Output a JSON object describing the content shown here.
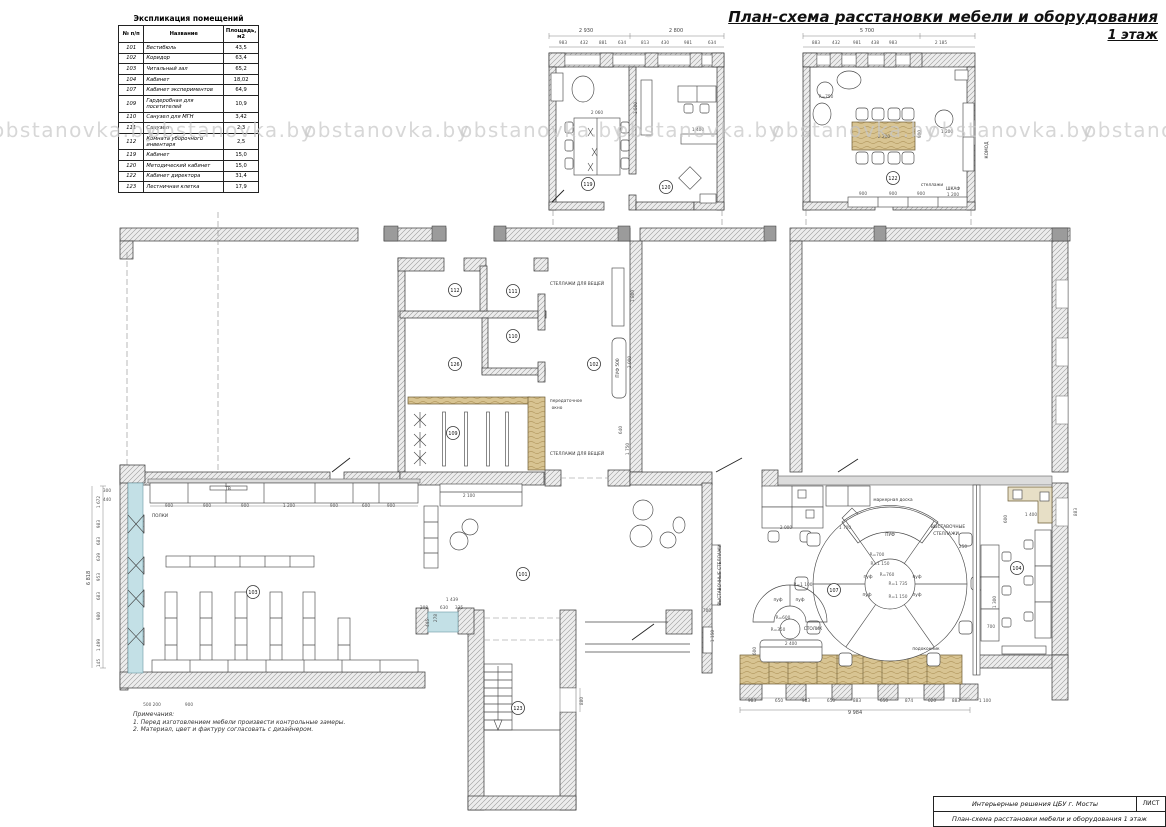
{
  "page": {
    "title_line1": "План-схема расстановки мебели и оборудования",
    "title_line2": "1 этаж"
  },
  "watermark": {
    "text": "obstanovka.by",
    "y": 118,
    "xs": [
      -8,
      148,
      304,
      460,
      616,
      772,
      928,
      1084
    ]
  },
  "legend": {
    "title": "Экспликация помещений",
    "headers": [
      "№ п/п",
      "Название",
      "Площадь, м2"
    ],
    "rows": [
      [
        "101",
        "Вестибюль",
        "43,5"
      ],
      [
        "102",
        "Коридор",
        "63,4"
      ],
      [
        "103",
        "Читальный зал",
        "65,2"
      ],
      [
        "104",
        "Кабинет",
        "18,02"
      ],
      [
        "107",
        "Кабинет экспериментов",
        "64,9"
      ],
      [
        "109",
        "Гардеробная для посетителей",
        "10,9"
      ],
      [
        "110",
        "Санузел для МГН",
        "3,42"
      ],
      [
        "111",
        "Санузел",
        "2,3"
      ],
      [
        "112",
        "Комната уборочного инвентаря",
        "2,5"
      ],
      [
        "119",
        "Кабинет",
        "15,0"
      ],
      [
        "120",
        "Методический кабинет",
        "15,0"
      ],
      [
        "122",
        "Кабинет директора",
        "31,4"
      ],
      [
        "123",
        "Лестничная клетка",
        "17,9"
      ]
    ]
  },
  "notes": {
    "heading": "Примечания:",
    "items": [
      "1. Перед изготовлением мебели произвести контрольные замеры.",
      "2. Материал, цвет и фактуру согласовать с дизайнером."
    ]
  },
  "title_block": {
    "project": "Интерьерные решения ЦБУ г. Мосты",
    "sheet_label": "ЛИСТ",
    "drawing_title": "План-схема расстановки мебели и оборудования 1 этаж"
  },
  "colors": {
    "wall_hatch": "#9b9b9b",
    "wall_band": "#dcdcdc",
    "accent_wood": "#d8c492",
    "accent_blue": "#c3e0e6",
    "watermark": "#c7c7c7"
  },
  "plan": {
    "rooms": [
      {
        "number": "119",
        "x": 588,
        "y": 184
      },
      {
        "number": "120",
        "x": 666,
        "y": 187
      },
      {
        "number": "122",
        "x": 893,
        "y": 178
      },
      {
        "number": "112",
        "x": 455,
        "y": 290
      },
      {
        "number": "111",
        "x": 513,
        "y": 291
      },
      {
        "number": "110",
        "x": 513,
        "y": 336
      },
      {
        "number": "126",
        "x": 455,
        "y": 364
      },
      {
        "number": "102",
        "x": 594,
        "y": 364
      },
      {
        "number": "109",
        "x": 453,
        "y": 433
      },
      {
        "number": "101",
        "x": 523,
        "y": 574
      },
      {
        "number": "103",
        "x": 253,
        "y": 592
      },
      {
        "number": "107",
        "x": 834,
        "y": 590
      },
      {
        "number": "104",
        "x": 1017,
        "y": 568
      },
      {
        "number": "123",
        "x": 518,
        "y": 708
      }
    ],
    "texts": [
      {
        "t": "2 930",
        "x": 586,
        "y": 32,
        "c": "tD"
      },
      {
        "t": "2 800",
        "x": 676,
        "y": 32,
        "c": "tD"
      },
      {
        "t": "983",
        "x": 563,
        "y": 44
      },
      {
        "t": "432",
        "x": 584,
        "y": 44
      },
      {
        "t": "881",
        "x": 603,
        "y": 44
      },
      {
        "t": "634",
        "x": 622,
        "y": 44
      },
      {
        "t": "813",
        "x": 645,
        "y": 44
      },
      {
        "t": "430",
        "x": 665,
        "y": 44
      },
      {
        "t": "981",
        "x": 688,
        "y": 44
      },
      {
        "t": "634",
        "x": 712,
        "y": 44
      },
      {
        "t": "2 060",
        "x": 597,
        "y": 114
      },
      {
        "t": "1 500",
        "x": 637,
        "y": 108,
        "r": -90
      },
      {
        "t": "1 400",
        "x": 698,
        "y": 131
      },
      {
        "t": "5 700",
        "x": 867,
        "y": 32,
        "c": "tD"
      },
      {
        "t": "883",
        "x": 816,
        "y": 44
      },
      {
        "t": "432",
        "x": 836,
        "y": 44
      },
      {
        "t": "981",
        "x": 857,
        "y": 44
      },
      {
        "t": "438",
        "x": 875,
        "y": 44
      },
      {
        "t": "983",
        "x": 893,
        "y": 44
      },
      {
        "t": "2 185",
        "x": 941,
        "y": 44
      },
      {
        "t": "R=750",
        "x": 826,
        "y": 98
      },
      {
        "t": "2 200",
        "x": 884,
        "y": 138
      },
      {
        "t": "900",
        "x": 921,
        "y": 134,
        "r": -90
      },
      {
        "t": "1 200",
        "x": 947,
        "y": 133
      },
      {
        "t": "стеллажи",
        "x": 932,
        "y": 186,
        "c": "tl"
      },
      {
        "t": "900",
        "x": 863,
        "y": 195
      },
      {
        "t": "900",
        "x": 893,
        "y": 195
      },
      {
        "t": "900",
        "x": 921,
        "y": 195
      },
      {
        "t": "ШКАФ",
        "x": 953,
        "y": 190,
        "c": "tl"
      },
      {
        "t": "1 200",
        "x": 953,
        "y": 196
      },
      {
        "t": "КОМОД",
        "x": 988,
        "y": 150,
        "r": -90,
        "c": "tl"
      },
      {
        "t": "СТЕЛЛАЖИ ДЛЯ ВЕЩЕЙ",
        "x": 577,
        "y": 285,
        "c": "tl"
      },
      {
        "t": "СТЕЛЛАЖИ ДЛЯ ВЕЩЕЙ",
        "x": 577,
        "y": 455,
        "c": "tl"
      },
      {
        "t": "1 800",
        "x": 634,
        "y": 296,
        "r": -90
      },
      {
        "t": "2 000",
        "x": 631,
        "y": 362,
        "r": -90
      },
      {
        "t": "ПУФ 500",
        "x": 619,
        "y": 368,
        "r": -90,
        "c": "tl"
      },
      {
        "t": "передаточное",
        "x": 566,
        "y": 402,
        "c": "tl"
      },
      {
        "t": "окно",
        "x": 557,
        "y": 409,
        "c": "tl"
      },
      {
        "t": "640",
        "x": 622,
        "y": 430,
        "r": -90
      },
      {
        "t": "1 750",
        "x": 629,
        "y": 449,
        "r": -90
      },
      {
        "t": "2 100",
        "x": 469,
        "y": 497
      },
      {
        "t": "1 439",
        "x": 452,
        "y": 601
      },
      {
        "t": "208",
        "x": 424,
        "y": 609
      },
      {
        "t": "630",
        "x": 444,
        "y": 609
      },
      {
        "t": "335",
        "x": 459,
        "y": 609
      },
      {
        "t": "445",
        "x": 429,
        "y": 623,
        "r": -90
      },
      {
        "t": "278",
        "x": 437,
        "y": 618,
        "r": -90
      },
      {
        "t": "880",
        "x": 583,
        "y": 701,
        "r": -90
      },
      {
        "t": "900",
        "x": 169,
        "y": 507
      },
      {
        "t": "900",
        "x": 207,
        "y": 507
      },
      {
        "t": "900",
        "x": 245,
        "y": 507
      },
      {
        "t": "1 200",
        "x": 289,
        "y": 507
      },
      {
        "t": "900",
        "x": 334,
        "y": 507
      },
      {
        "t": "600",
        "x": 366,
        "y": 507
      },
      {
        "t": "900",
        "x": 391,
        "y": 507
      },
      {
        "t": "ПОЛКИ",
        "x": 160,
        "y": 517,
        "c": "tl"
      },
      {
        "t": "ТВ",
        "x": 228,
        "y": 490,
        "c": "tl"
      },
      {
        "t": "500 200",
        "x": 152,
        "y": 706
      },
      {
        "t": "900",
        "x": 189,
        "y": 706
      },
      {
        "t": "300",
        "x": 107,
        "y": 492
      },
      {
        "t": "440",
        "x": 107,
        "y": 501
      },
      {
        "t": "1 672",
        "x": 100,
        "y": 502,
        "r": -90
      },
      {
        "t": "983",
        "x": 100,
        "y": 524,
        "r": -90
      },
      {
        "t": "683",
        "x": 100,
        "y": 541,
        "r": -90
      },
      {
        "t": "639",
        "x": 100,
        "y": 557,
        "r": -90
      },
      {
        "t": "953",
        "x": 100,
        "y": 577,
        "r": -90
      },
      {
        "t": "683",
        "x": 100,
        "y": 596,
        "r": -90
      },
      {
        "t": "980",
        "x": 100,
        "y": 616,
        "r": -90
      },
      {
        "t": "1 499",
        "x": 100,
        "y": 645,
        "r": -90
      },
      {
        "t": "145",
        "x": 100,
        "y": 663,
        "r": -90
      },
      {
        "t": "6 818",
        "x": 90,
        "y": 578,
        "r": -90,
        "c": "tD"
      },
      {
        "t": "2 000",
        "x": 786,
        "y": 529
      },
      {
        "t": "1 700",
        "x": 845,
        "y": 529
      },
      {
        "t": "маркерная доска",
        "x": 893,
        "y": 501,
        "c": "tl"
      },
      {
        "t": "ПУФ",
        "x": 890,
        "y": 536,
        "c": "tl"
      },
      {
        "t": "R=700",
        "x": 877,
        "y": 556
      },
      {
        "t": "R=1 150",
        "x": 880,
        "y": 565
      },
      {
        "t": "R=760",
        "x": 887,
        "y": 576
      },
      {
        "t": "R=1 735",
        "x": 898,
        "y": 585
      },
      {
        "t": "R=1 150",
        "x": 898,
        "y": 598
      },
      {
        "t": "пуф",
        "x": 868,
        "y": 578,
        "c": "tl"
      },
      {
        "t": "пуф",
        "x": 917,
        "y": 578,
        "c": "tl"
      },
      {
        "t": "пуф",
        "x": 867,
        "y": 596,
        "c": "tl"
      },
      {
        "t": "пуф",
        "x": 917,
        "y": 596,
        "c": "tl"
      },
      {
        "t": "R=1 100",
        "x": 803,
        "y": 586
      },
      {
        "t": "пуф",
        "x": 778,
        "y": 601,
        "c": "tl"
      },
      {
        "t": "пуф",
        "x": 800,
        "y": 601,
        "c": "tl"
      },
      {
        "t": "R=600",
        "x": 783,
        "y": 619
      },
      {
        "t": "R=350",
        "x": 778,
        "y": 631
      },
      {
        "t": "СТОЛИК",
        "x": 813,
        "y": 630,
        "c": "tl"
      },
      {
        "t": "2 400",
        "x": 791,
        "y": 645
      },
      {
        "t": "600",
        "x": 756,
        "y": 651,
        "r": -90
      },
      {
        "t": "700",
        "x": 707,
        "y": 612
      },
      {
        "t": "1 150",
        "x": 714,
        "y": 636,
        "r": -90
      },
      {
        "t": "ВЫСТАВОЧНЫЕ",
        "x": 948,
        "y": 528,
        "c": "tl"
      },
      {
        "t": "СТЕЛЛАЖИ",
        "x": 946,
        "y": 535,
        "c": "tl"
      },
      {
        "t": "ВЫСТАВОЧНЫЕ СТЕЛЛАЖИ",
        "x": 721,
        "y": 575,
        "r": -90,
        "c": "tl"
      },
      {
        "t": "подоконник",
        "x": 926,
        "y": 650,
        "c": "tl"
      },
      {
        "t": "983",
        "x": 752,
        "y": 702
      },
      {
        "t": "650",
        "x": 779,
        "y": 702
      },
      {
        "t": "983",
        "x": 806,
        "y": 702
      },
      {
        "t": "650",
        "x": 831,
        "y": 702
      },
      {
        "t": "883",
        "x": 857,
        "y": 702
      },
      {
        "t": "650",
        "x": 884,
        "y": 702
      },
      {
        "t": "874",
        "x": 909,
        "y": 702
      },
      {
        "t": "620",
        "x": 932,
        "y": 702
      },
      {
        "t": "883",
        "x": 956,
        "y": 702
      },
      {
        "t": "1 100",
        "x": 985,
        "y": 702
      },
      {
        "t": "9 984",
        "x": 855,
        "y": 714,
        "c": "tD"
      },
      {
        "t": "1 400",
        "x": 1031,
        "y": 516
      },
      {
        "t": "600",
        "x": 1007,
        "y": 519,
        "r": -90
      },
      {
        "t": "883",
        "x": 1077,
        "y": 512,
        "r": -90
      },
      {
        "t": "1 300",
        "x": 996,
        "y": 602,
        "r": -90
      },
      {
        "t": "700",
        "x": 991,
        "y": 628
      },
      {
        "t": "250",
        "x": 963,
        "y": 548
      }
    ]
  }
}
